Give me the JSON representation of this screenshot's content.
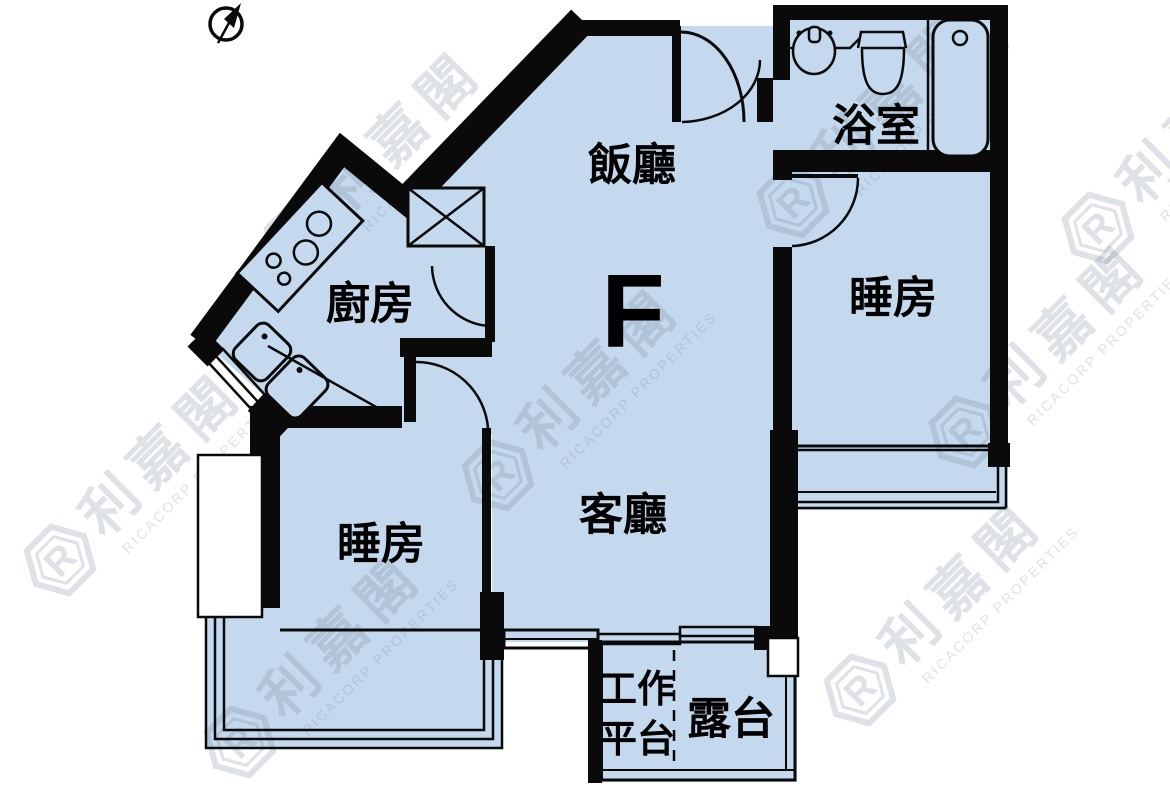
{
  "page": {
    "background": "#ffffff"
  },
  "unit": {
    "label": "F"
  },
  "rooms": {
    "dining": {
      "label": "飯廳"
    },
    "bathroom": {
      "label": "浴室"
    },
    "bedroom_right": {
      "label": "睡房"
    },
    "kitchen": {
      "label": "廚房"
    },
    "living": {
      "label": "客廳"
    },
    "bedroom_left": {
      "label": "睡房"
    },
    "work_platform": {
      "label_line1": "工作",
      "label_line2": "平台"
    },
    "balcony": {
      "label": "露台"
    }
  },
  "icons": {
    "compass": "north-arrow-icon",
    "bathtub": "bathtub-icon",
    "toilet": "toilet-icon",
    "basin": "wash-basin-icon",
    "stove": "stove-icon",
    "kitchen_sink": "kitchen-sink-icon",
    "shaft": "duct-shaft-icon"
  },
  "watermark": {
    "logo_letter": "R",
    "cjk": "利嘉閣",
    "latin": "RICACORP PROPERTIES"
  },
  "colors": {
    "floor": "#C5D9EE",
    "wall": "#0A0A0A",
    "watermark": "rgba(105,118,138,0.22)"
  }
}
